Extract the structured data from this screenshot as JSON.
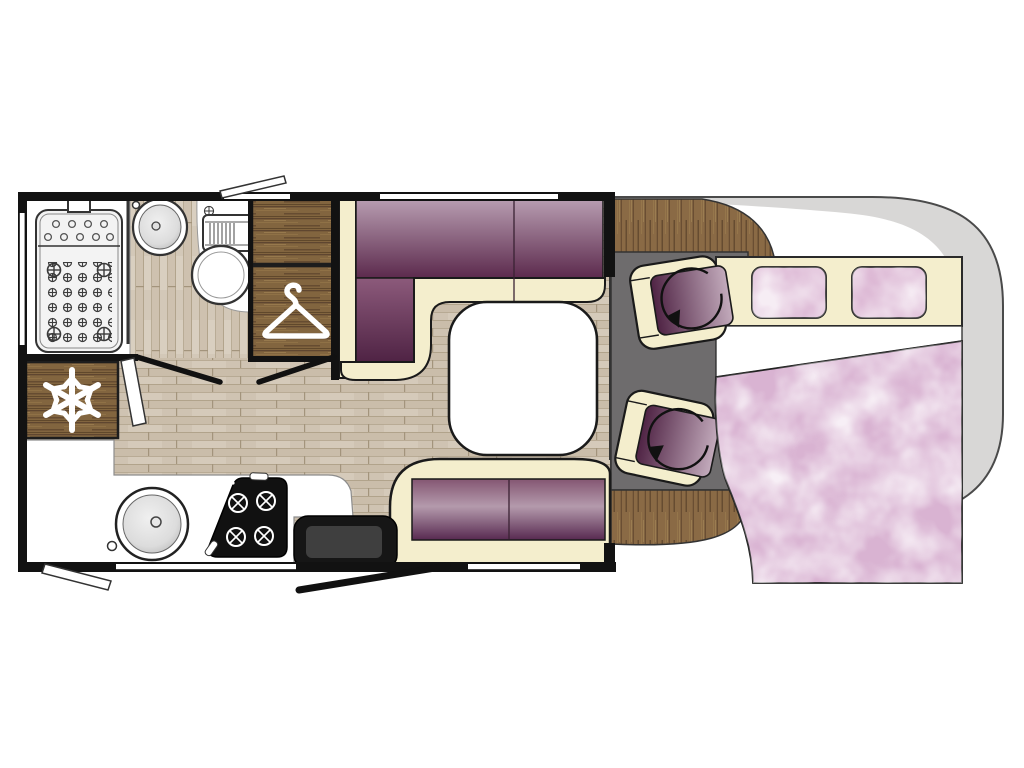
{
  "plan": {
    "type": "motorhome-floor-plan",
    "view": "top-down",
    "zones": [
      {
        "name": "washroom",
        "items": [
          "shower-tray",
          "washbasin",
          "toilet"
        ]
      },
      {
        "name": "storage",
        "items": [
          "overhead-locker",
          "wardrobe",
          "refrigerator"
        ]
      },
      {
        "name": "kitchen",
        "items": [
          "round-sink",
          "gas-hob",
          "worktop"
        ]
      },
      {
        "name": "lounge",
        "items": [
          "l-shaped-sofa",
          "table",
          "bench-seat",
          "entry-step",
          "entry-door"
        ]
      },
      {
        "name": "cab",
        "items": [
          "swivel-seat",
          "swivel-seat",
          "dashboard",
          "drop-down-bed",
          "pillows",
          "duvet"
        ]
      }
    ]
  },
  "icons": {
    "snowflake": "refrigerator-freezer",
    "hanger": "wardrobe",
    "rotation_arrow": "swivel-seat",
    "drain_plus": "shower-drain",
    "burner_cross": "gas-burner"
  },
  "colors": {
    "background": "#ffffff",
    "wall": "#121212",
    "outline": "#1a1a1a",
    "cream": "#f4eecd",
    "plum_light": "#b79cb0",
    "plum_dark": "#5c2a4d",
    "plum_mid": "#8c5a7b",
    "plum_deep": "#4f2344",
    "bench_top": "#845672",
    "bench_mid": "#b49aac",
    "bench_bottom": "#572950",
    "seat_dark": "#4f2344",
    "seat_light": "#c3abbc",
    "wood": "#82653f",
    "wood_dark": "#5f4630",
    "laminate": "#cfc3b2",
    "laminate_dark": "#b7a78f",
    "cab_floor": "#6e6c6d",
    "body_gray": "#d8d7d6",
    "duvet_pink": "#d9b3d2",
    "pillow_pink": "#ddb9d5",
    "sheet_white": "#ffffff",
    "table_white": "#ffffff",
    "step_black": "#161616",
    "stove_black": "#111111",
    "icon_white": "#ffffff"
  }
}
